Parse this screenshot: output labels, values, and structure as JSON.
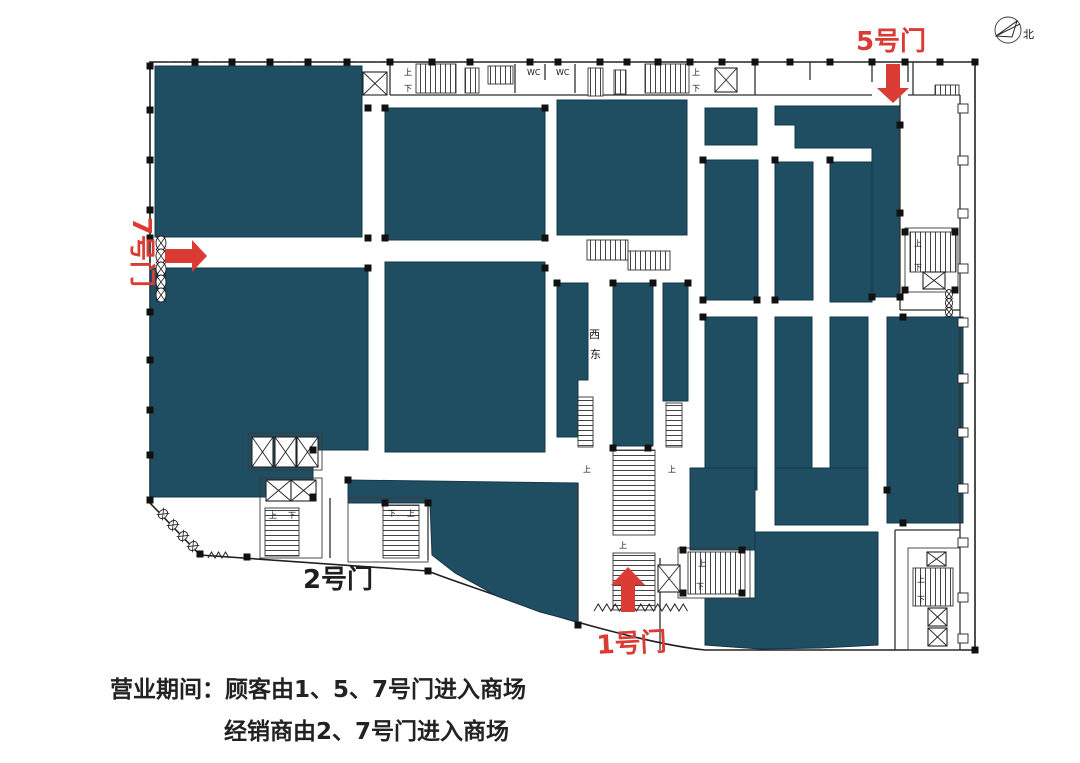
{
  "colors": {
    "block": "#1f4d61",
    "door_red": "#da3b34",
    "line": "#2f2f2f",
    "text_dark": "#1f1f1f",
    "bg": "#ffffff"
  },
  "doors": {
    "d1": {
      "label": "1号门"
    },
    "d2": {
      "label": "2号门"
    },
    "d5": {
      "label": "5号门"
    },
    "d7": {
      "label": "7号门"
    }
  },
  "compass": {
    "label": "北"
  },
  "map_labels": {
    "west": "西",
    "east": "东",
    "wc": "WC",
    "stair_up": "上",
    "stair_down": "下"
  },
  "notice": {
    "line1": "营业期间：顾客由1、5、7号门进入商场",
    "line2": "经销商由2、7号门进入商场"
  }
}
